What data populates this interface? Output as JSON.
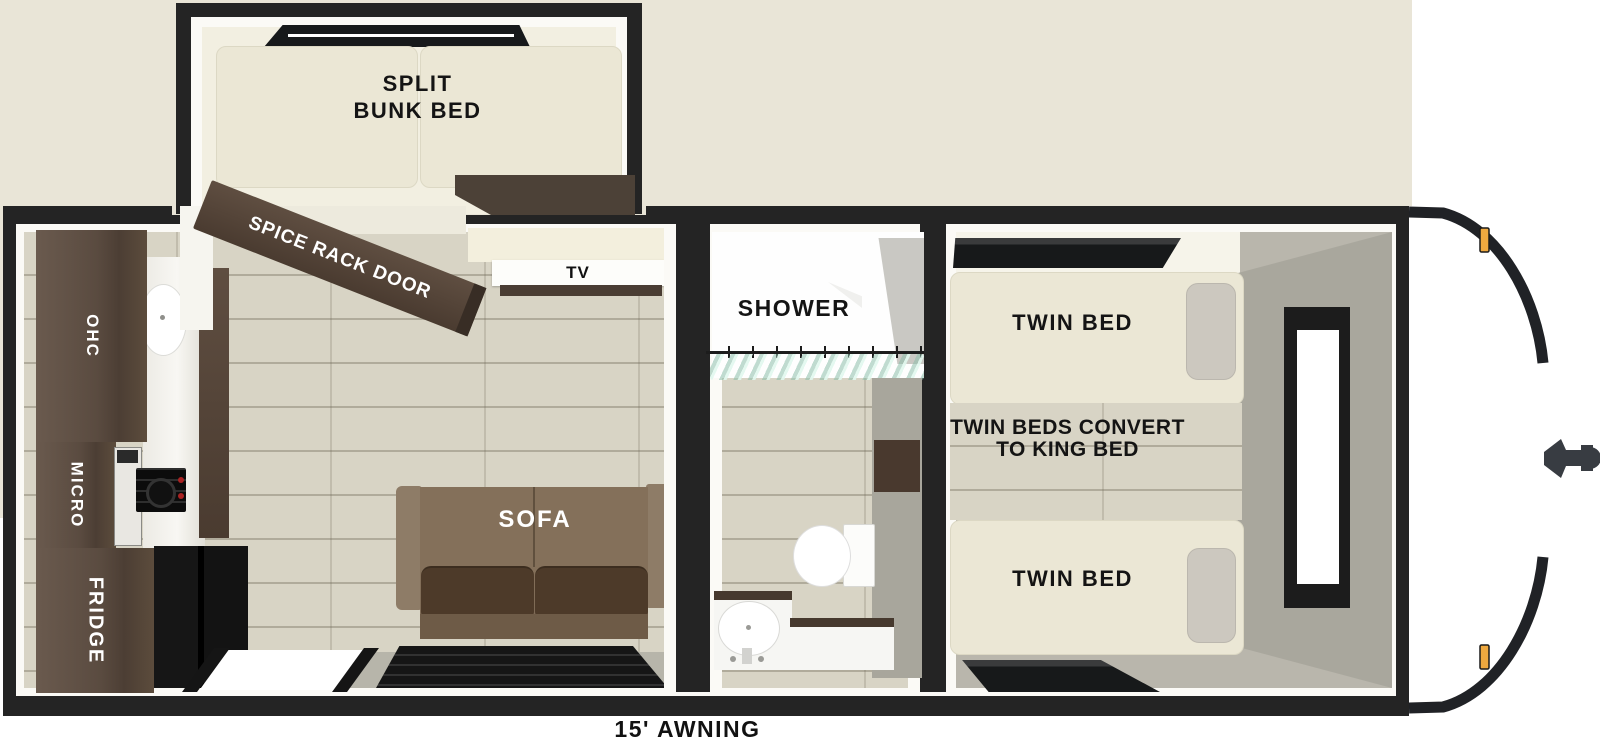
{
  "floorplan": {
    "awning_label": "15' AWNING",
    "bunk_room": {
      "bed_line1": "SPLIT",
      "bed_line2": "BUNK BED",
      "spice_rack_label": "SPICE RACK DOOR"
    },
    "living_room": {
      "tv_label": "TV",
      "sofa_label": "SOFA"
    },
    "kitchen": {
      "overhead_cabinet_label": "OHC",
      "microwave_label": "MICRO",
      "fridge_label": "FRIDGE"
    },
    "bathroom": {
      "shower_label": "SHOWER"
    },
    "bedroom": {
      "twin_bed_top_label": "TWIN BED",
      "twin_bed_bottom_label": "TWIN BED",
      "convert_line1": "TWIN BEDS CONVERT",
      "convert_line2": "TO KING BED"
    },
    "colors": {
      "wall": "#242424",
      "wood_cabinet": "#584a3f",
      "wood_floor": "#d8d4c5",
      "mattress": "#ebe7d5",
      "sofa": "#7a6753",
      "gray_floor": "#b9b6ac",
      "marker_light": "#efa93f"
    }
  }
}
